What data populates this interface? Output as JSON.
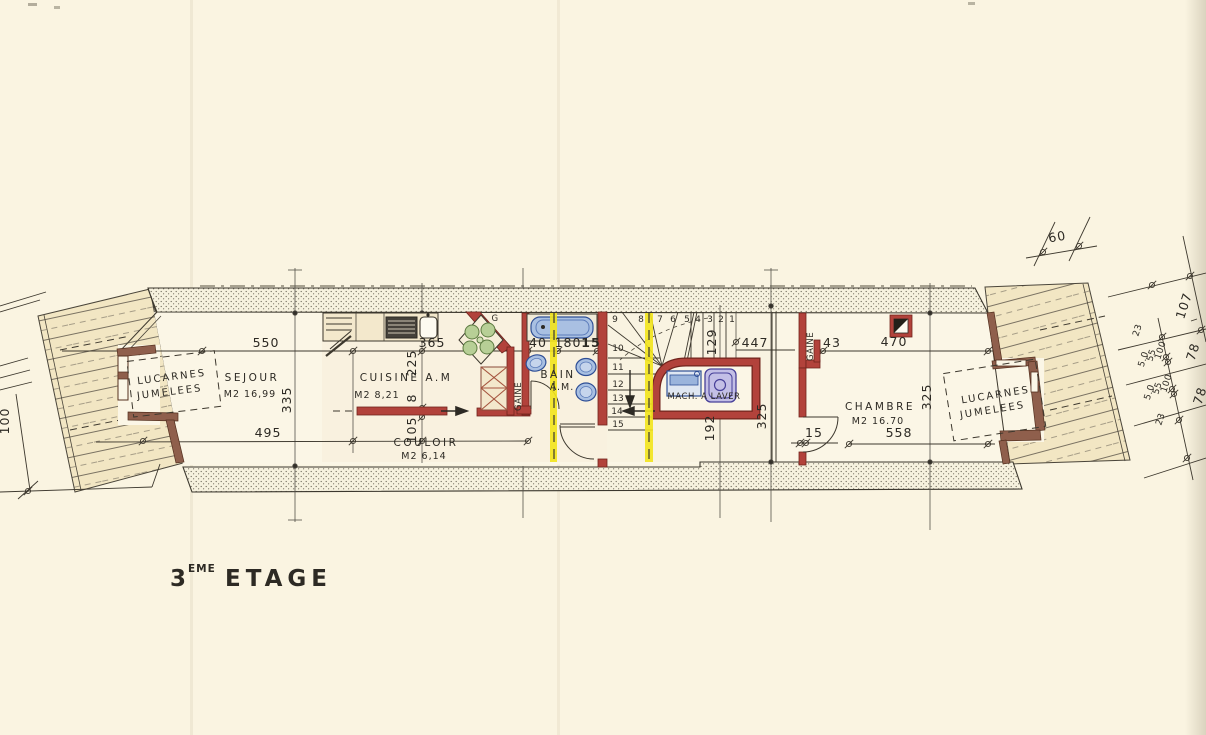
{
  "title": {
    "number": "3",
    "superscript": "EME",
    "word": "ETAGE"
  },
  "rooms": {
    "sejour": {
      "name": "SEJOUR",
      "area": "M2 16,99"
    },
    "cuisine": {
      "name": "CUISINE A.M",
      "area": "M2 8,21"
    },
    "couloir": {
      "name": "COULOIR",
      "area": "M2 6,14"
    },
    "bain": {
      "name": "BAIN",
      "sub": "A.M."
    },
    "chambre": {
      "name": "CHAMBRE",
      "area": "M2 16.70"
    }
  },
  "labels": {
    "gaine": "GAINE",
    "gaine_right": "GAINE",
    "mach_a_laver": "MACH. A LAVER",
    "g": "G",
    "lucarnes_line1": "LUCARNES",
    "lucarnes_line2": "JUMELEES",
    "lucarnes_right_line1": "LUCARNES",
    "lucarnes_right_line2": "JUMELEES"
  },
  "stairs": {
    "top": [
      "9",
      "8",
      "7",
      "6",
      "5",
      "4",
      "3",
      "2",
      "1"
    ],
    "side": [
      "10",
      "11",
      "12",
      "13",
      "14",
      "15"
    ]
  },
  "dims": {
    "d550": "550",
    "d365": "365",
    "d40": "40",
    "d180": "180",
    "d15_bath": "15",
    "d447": "447",
    "d43": "43",
    "d470": "470",
    "d495": "495",
    "d15_door": "15",
    "d558": "558",
    "d335": "335",
    "d225": "225",
    "d8": "8",
    "d105": "105",
    "d129": "129",
    "d192": "192",
    "d325_mid": "325",
    "d325_right": "325",
    "d60": "60",
    "d107": "107",
    "d78_a": "78",
    "d78_b": "78",
    "d23_a": "23",
    "d50_a": "5.0",
    "d55_a": "55",
    "d100_a": "100",
    "d23_b": "23",
    "d50_b": "5.0",
    "d55_b": "55",
    "d100_b": "100",
    "d100_left": "100"
  },
  "colors": {
    "paper": "#faf4e1",
    "wall_red": "#b2423b",
    "highlight_yellow": "#f2e41c",
    "fixture_blue": "#a9c0e2",
    "roof_beige": "#f2e6c3"
  }
}
